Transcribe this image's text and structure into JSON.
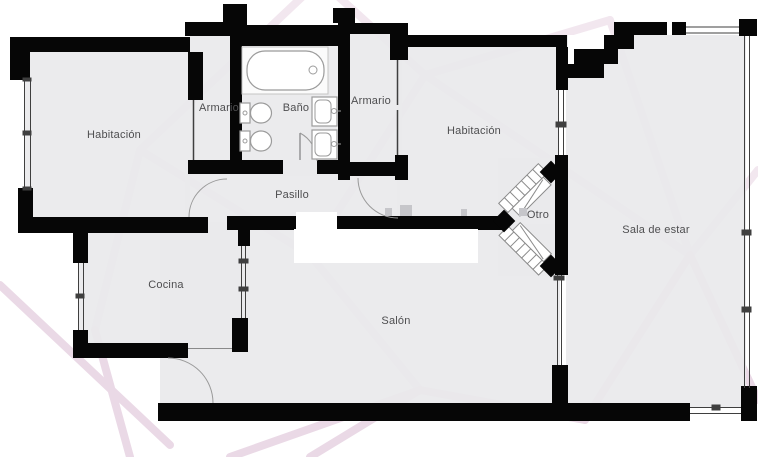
{
  "image_type": "apartment-floor-plan",
  "rooms": {
    "habitacion_izquierda": {
      "label": "Habitación"
    },
    "armario_1": {
      "label": "Armario"
    },
    "bano": {
      "label": "Baño"
    },
    "armario_2": {
      "label": "Armario"
    },
    "habitacion_derecha": {
      "label": "Habitación"
    },
    "pasillo": {
      "label": "Pasillo"
    },
    "otro": {
      "label": "Otro"
    },
    "sala_de_estar": {
      "label": "Sala de estar"
    },
    "cocina": {
      "label": "Cocina"
    },
    "salon": {
      "label": "Salón"
    }
  },
  "fixtures": {
    "bathtub": "bathtub-icon",
    "toilets": [
      "toilet-icon",
      "toilet-icon"
    ],
    "sinks": [
      "sink-icon",
      "sink-icon"
    ],
    "diagonal_units": [
      "diagonal-radiator-icon",
      "diagonal-radiator-icon"
    ]
  },
  "colors": {
    "walls": "#060606",
    "floor": "#e9e9eb",
    "pattern_lines": "#f2e7ef",
    "pattern_lines_dark": "#ead9e6",
    "label_text": "#4e4e50",
    "fixture_stroke": "#999999",
    "background": "#ffffff"
  }
}
